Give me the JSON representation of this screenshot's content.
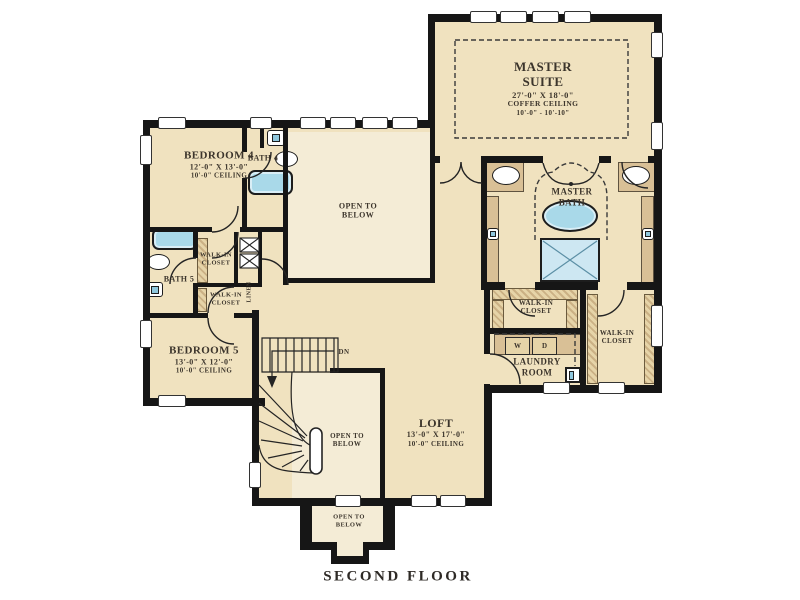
{
  "title": "SECOND FLOOR",
  "colors": {
    "room_fill": "#f0e2bf",
    "two_story_fill": "#f4ecd6",
    "wall": "#161616",
    "fixture_blue": "#a9d9e9",
    "counter_tan": "#d9c096",
    "text": "#3c352c"
  },
  "rooms": {
    "master_suite": {
      "name": "MASTER SUITE",
      "dims": "27'-0\" X 18'-0\"",
      "ceiling": "COFFER CEILING",
      "ceiling_range": "10'-0\" - 10'-10\""
    },
    "master_bath": {
      "name": "MASTER BATH"
    },
    "bedroom4": {
      "name": "BEDROOM 4",
      "dims": "12'-0\" X 13'-0\"",
      "ceiling": "10'-0\" CEILING"
    },
    "bedroom5": {
      "name": "BEDROOM 5",
      "dims": "13'-0\" X 12'-0\"",
      "ceiling": "10'-0\" CEILING"
    },
    "loft": {
      "name": "LOFT",
      "dims": "13'-0\" X 17'-0\"",
      "ceiling": "10'-0\" CEILING"
    },
    "laundry": {
      "name": "LAUNDRY ROOM"
    },
    "bath4": {
      "name": "BATH 4"
    },
    "bath5": {
      "name": "BATH 5"
    },
    "wic_upper_left": {
      "name": "WALK-IN CLOSET"
    },
    "wic_lower_left": {
      "name": "WALK-IN CLOSET"
    },
    "wic_master_left": {
      "name": "WALK-IN CLOSET"
    },
    "wic_master_right": {
      "name": "WALK-IN CLOSET"
    },
    "linen": {
      "name": "LINEN"
    }
  },
  "annotations": {
    "open_to_below_center": "OPEN TO BELOW",
    "open_to_below_stair": "OPEN TO BELOW",
    "open_to_below_entry": "OPEN TO BELOW",
    "down": "DN",
    "washer": "W",
    "dryer": "D"
  }
}
